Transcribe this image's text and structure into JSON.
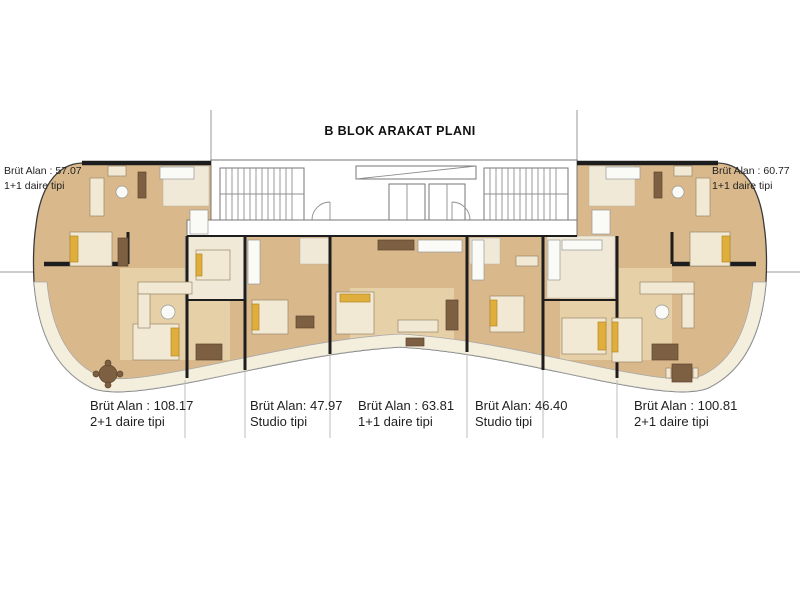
{
  "title": "B BLOK ARAKAT PLANI",
  "units": {
    "top_left": {
      "area_label": "Brüt Alan : 57.07",
      "type_label": "1+1 daire tipi"
    },
    "top_right": {
      "area_label": "Brüt Alan : 60.77",
      "type_label": "1+1 daire tipi"
    },
    "bottom_left_corner": {
      "area_label": "Brüt Alan : 108.17",
      "type_label": "2+1 daire tipi"
    },
    "bottom_studio_left": {
      "area_label": "Brüt Alan: 47.97",
      "type_label": "Studio tipi"
    },
    "bottom_center": {
      "area_label": "Brüt Alan : 63.81",
      "type_label": "1+1 daire tipi"
    },
    "bottom_studio_right": {
      "area_label": "Brüt Alan: 46.40",
      "type_label": "Studio tipi"
    },
    "bottom_right_corner": {
      "area_label": "Brüt Alan : 100.81",
      "type_label": "2+1 daire tipi"
    }
  },
  "colors": {
    "background": "#ffffff",
    "wood": "#d9b88c",
    "wood_light": "#ead8b2",
    "room_light": "#f0e9d7",
    "balcony": "#f4eedd",
    "wall": "#1d1d1d",
    "thin_line": "#8f8f8f",
    "accent_bed": "#dfae3c",
    "furniture_cream": "#f1e9d3",
    "furniture_brown": "#7d5f42"
  }
}
